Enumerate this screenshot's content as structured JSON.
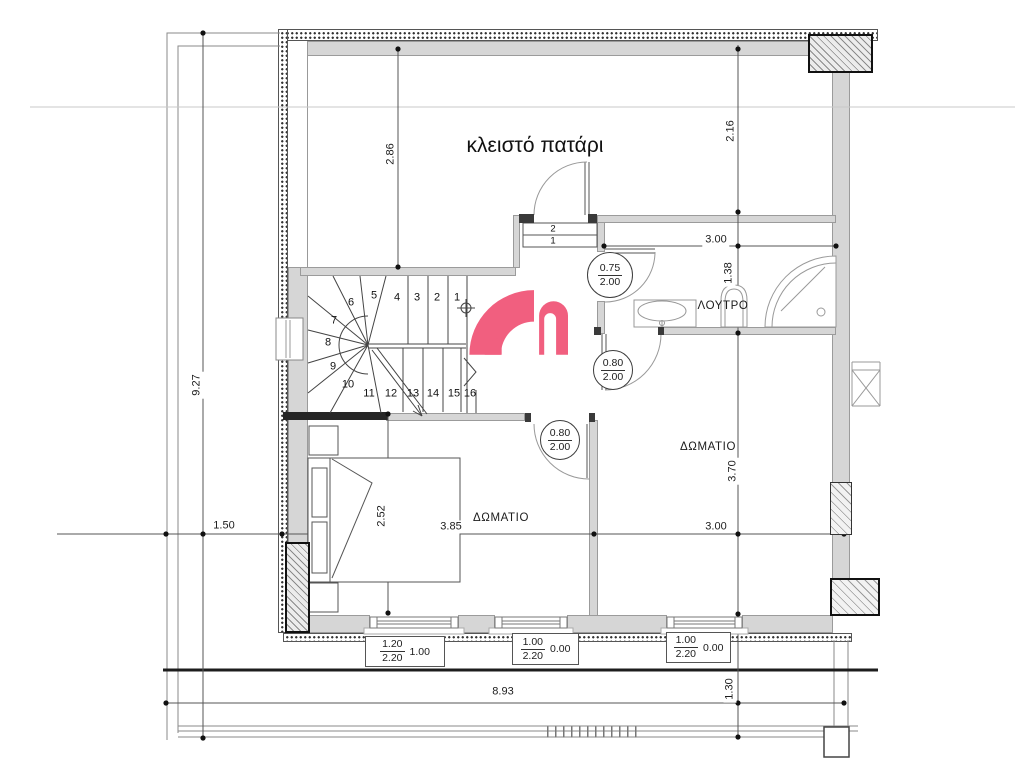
{
  "plan": {
    "loft_label": "κλειστό πατάρι",
    "rooms": {
      "bathroom": "ΛΟΥΤΡΟ",
      "bedroom_left": "ΔΩΜΑΤΙΟ",
      "bedroom_right": "ΔΩΜΑΤΙΟ"
    }
  },
  "dims": {
    "loft_interior_width": "2.86",
    "loft_right_depth": "2.16",
    "overall_left": "9.27",
    "terrace_left_offset": "1.50",
    "bath_width": "3.00",
    "bath_depth": "1.38",
    "bedroom_left_depth": "2.52",
    "bedroom_left_width": "3.85",
    "bedroom_right_width": "3.00",
    "bedroom_right_depth": "3.70",
    "terrace_width": "8.93",
    "terrace_depth": "1.30"
  },
  "doors": {
    "bath": {
      "width": "0.75",
      "height": "2.00"
    },
    "bedroom_right": {
      "width": "0.80",
      "height": "2.00"
    },
    "bedroom_left": {
      "width": "0.80",
      "height": "2.00"
    }
  },
  "windows": [
    {
      "width": "1.20",
      "height": "2.20",
      "sill": "1.00"
    },
    {
      "width": "1.00",
      "height": "2.20",
      "sill": "0.00"
    },
    {
      "width": "1.00",
      "height": "2.20",
      "sill": "0.00"
    }
  ],
  "stairs": {
    "steps": [
      "1",
      "2",
      "3",
      "4",
      "5",
      "6",
      "7",
      "8",
      "9",
      "10",
      "11",
      "12",
      "13",
      "14",
      "15",
      "16"
    ],
    "landing_steps": [
      "2",
      "1"
    ]
  },
  "logo_color": "#f15f7f"
}
